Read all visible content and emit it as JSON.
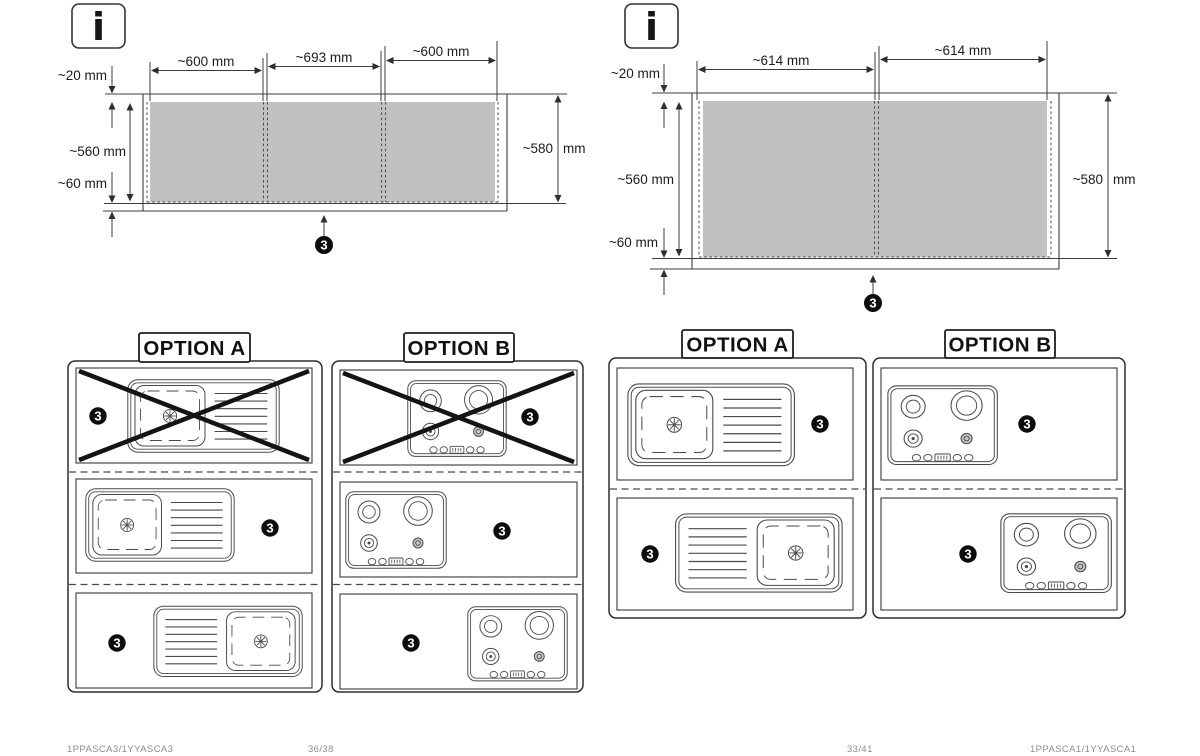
{
  "colors": {
    "zone_fill": "#c1c1c1",
    "line": "#3c3c3c",
    "badge_bg": "#0d0d0d"
  },
  "pages": [
    {
      "info_icon": "i",
      "diagram": {
        "widths": [
          "~600 mm",
          "~693 mm",
          "~600 mm"
        ],
        "top_offset": "~20 mm",
        "cutzone_depth": "~560 mm",
        "bottom_offset": "~60 mm",
        "total_depth": "~580",
        "total_depth_unit": "mm",
        "callout": "3"
      },
      "options": [
        {
          "label": "OPTION A",
          "rows": [
            {
              "fixture": "sink",
              "crossed": true,
              "badge": "3"
            },
            {
              "fixture": "sink",
              "crossed": false,
              "badge": "3"
            },
            {
              "fixture": "sink-mirrored",
              "crossed": false,
              "badge": "3"
            }
          ]
        },
        {
          "label": "OPTION B",
          "rows": [
            {
              "fixture": "cooktop",
              "crossed": true,
              "badge": "3"
            },
            {
              "fixture": "cooktop",
              "crossed": false,
              "badge": "3"
            },
            {
              "fixture": "cooktop",
              "crossed": false,
              "badge": "3"
            }
          ]
        }
      ],
      "footer": {
        "doc_code": "1PPASCA3/1YYASCA3",
        "page": "36/38"
      }
    },
    {
      "info_icon": "i",
      "diagram": {
        "widths": [
          "~614 mm",
          "~614 mm"
        ],
        "top_offset": "~20 mm",
        "cutzone_depth": "~560 mm",
        "bottom_offset": "~60 mm",
        "total_depth": "~580",
        "total_depth_unit": "mm",
        "callout": "3"
      },
      "options": [
        {
          "label": "OPTION A",
          "rows": [
            {
              "fixture": "sink",
              "crossed": false,
              "badge": "3"
            },
            {
              "fixture": "sink-mirrored",
              "crossed": false,
              "badge": "3"
            }
          ]
        },
        {
          "label": "OPTION B",
          "rows": [
            {
              "fixture": "cooktop",
              "crossed": false,
              "badge": "3"
            },
            {
              "fixture": "cooktop",
              "crossed": false,
              "badge": "3"
            }
          ]
        }
      ],
      "footer": {
        "doc_code": "1PPASCA1/1YYASCA1",
        "page": "33/41"
      }
    }
  ]
}
